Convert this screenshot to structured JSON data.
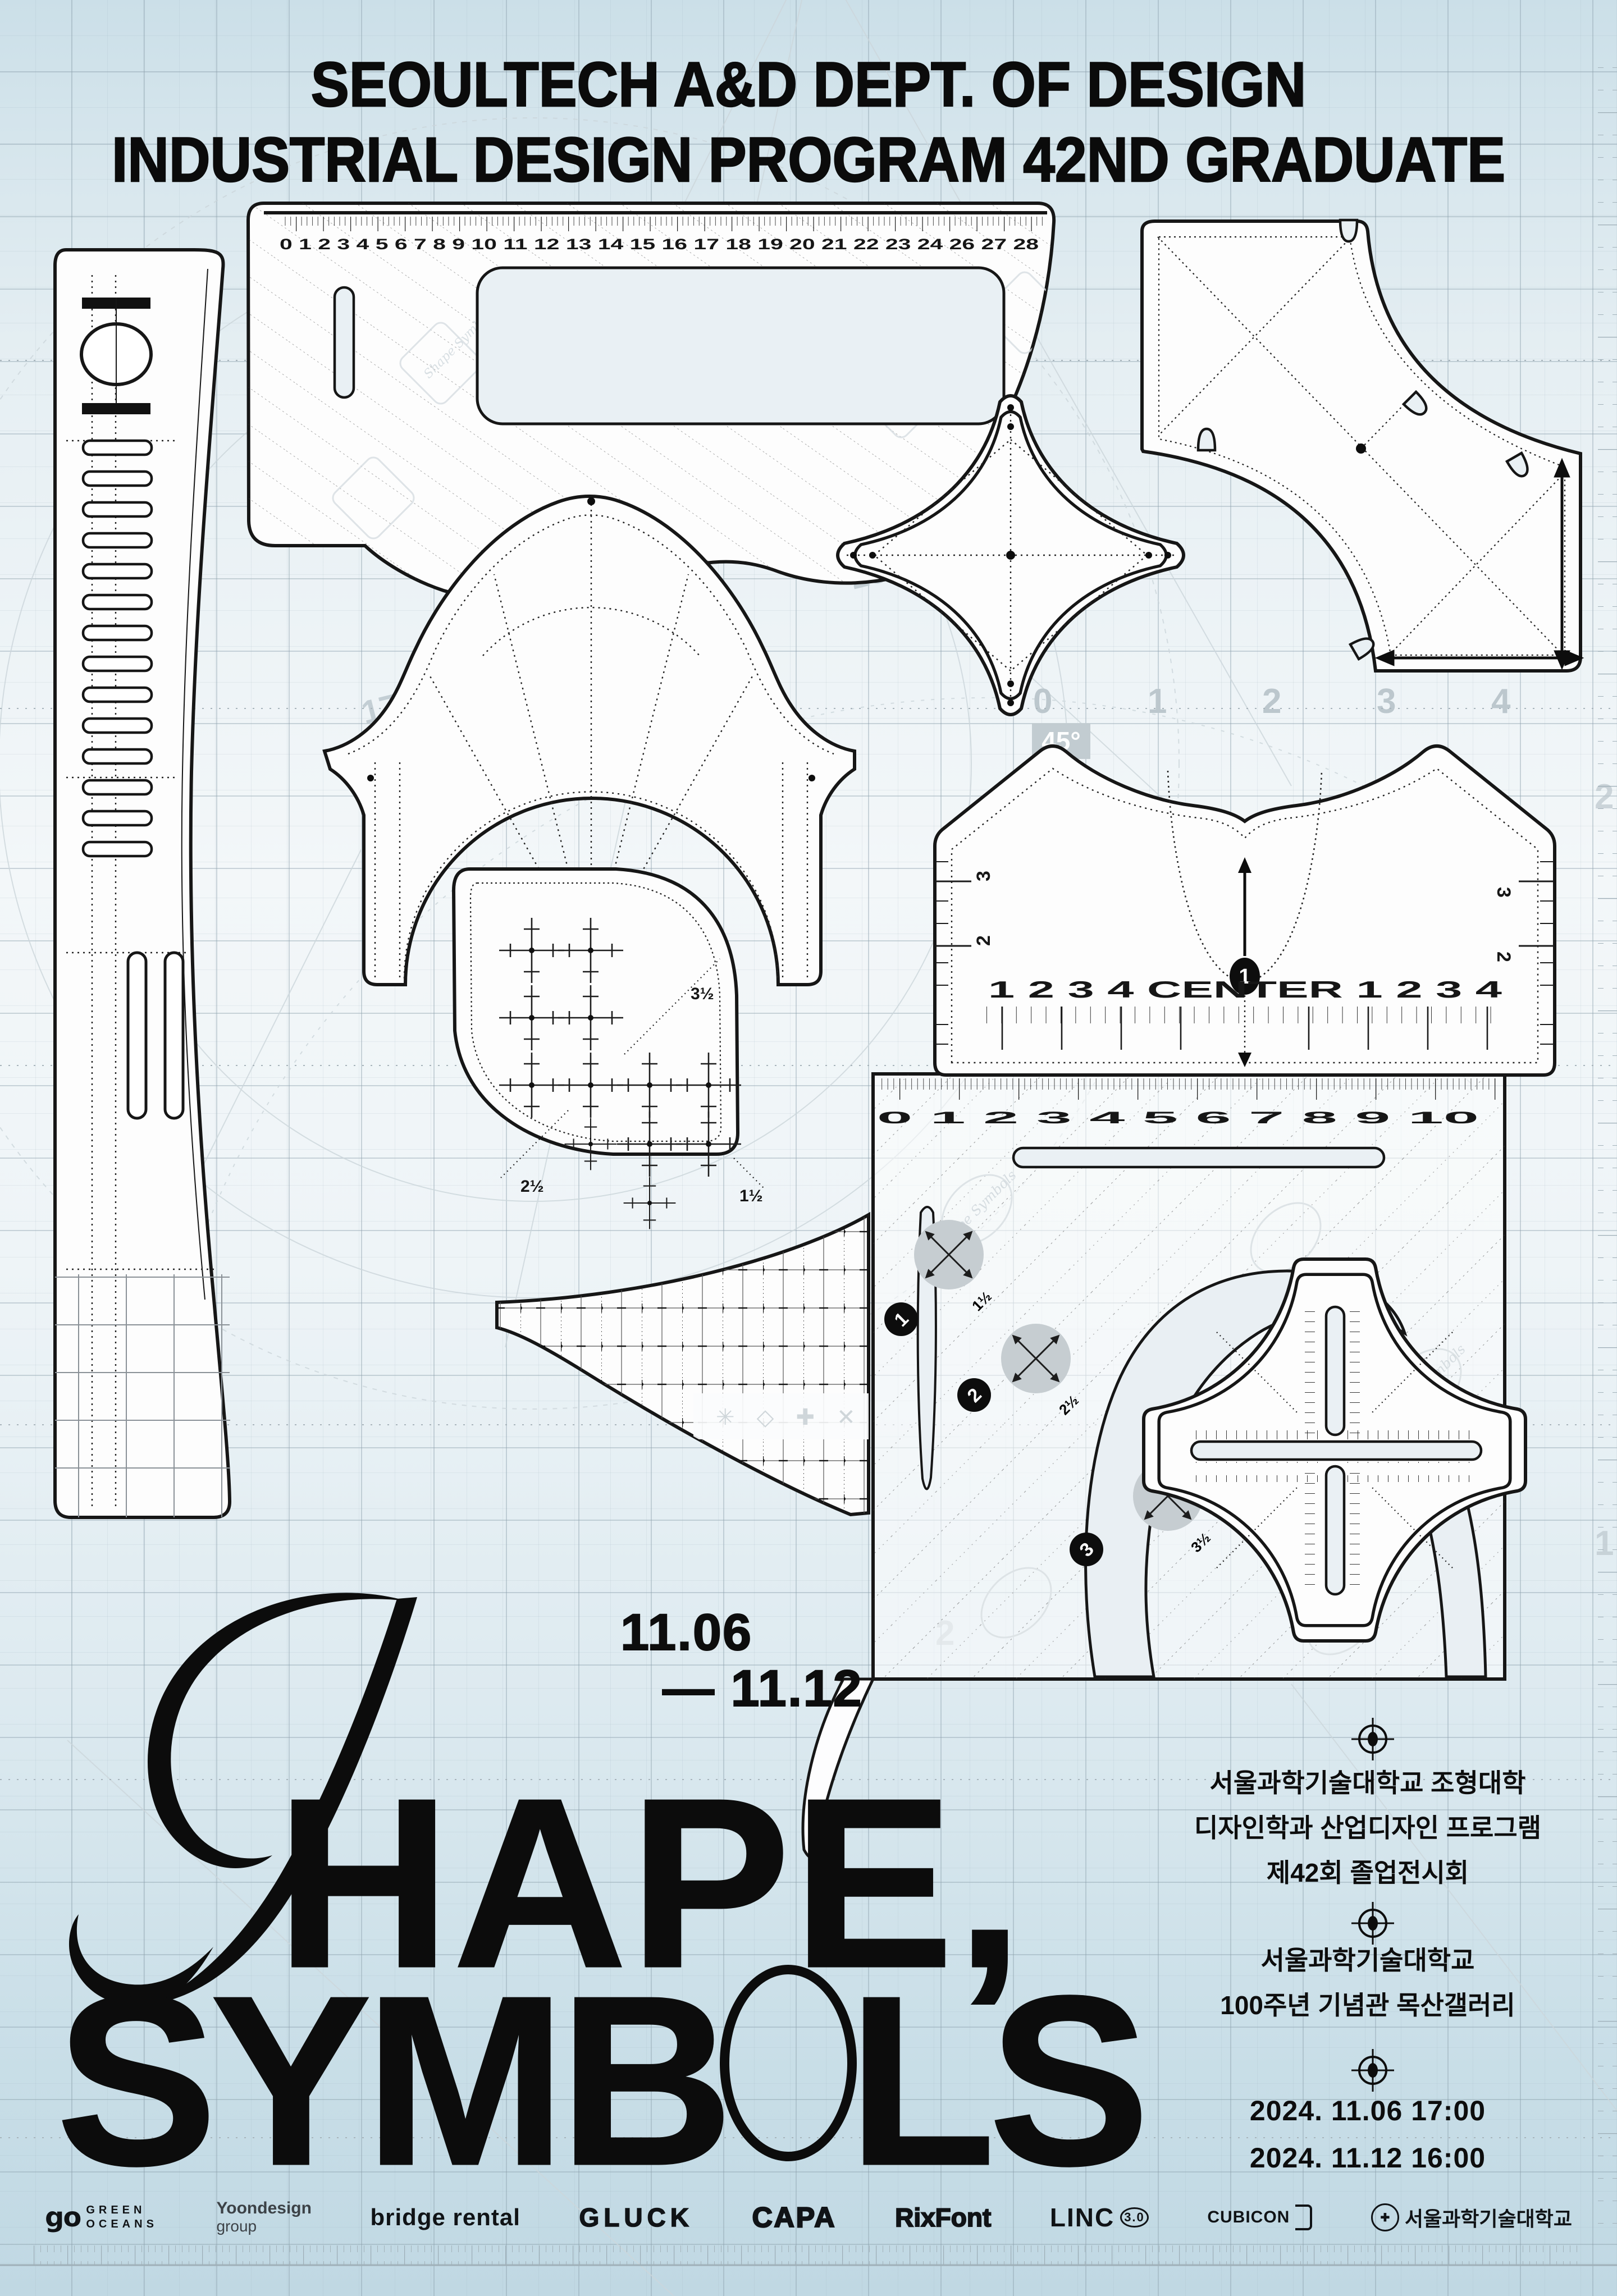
{
  "header": {
    "line1": "SEOULTECH A&D DEPT. OF DESIGN",
    "line2": "INDUSTRIAL DESIGN PROGRAM 42ND GRADUATE SHOW"
  },
  "dates_top": {
    "start": "11.06",
    "end": "— 11.12"
  },
  "title": {
    "script_letter": "S",
    "line1_rest": "HAPE,",
    "line2_pre": "SYMB",
    "line2_post": "LS"
  },
  "info": {
    "block1": [
      "서울과학기술대학교 조형대학",
      "디자인학과 산업디자인 프로그램",
      "제42회 졸업전시회"
    ],
    "block2": [
      "서울과학기술대학교",
      "100주년 기념관 목산갤러리"
    ],
    "block3": [
      "2024. 11.06  17:00",
      "2024. 11.12  16:00"
    ]
  },
  "rulers": {
    "triangle_scale": "0 1 2 3 4 5 6 7 8 9 10 11 12 13 14 15 16 17 18 19 20 21 22 23 24 26 27 28",
    "square_scale": "0 1 2 3 4 5 6 7 8 9 10",
    "square_circle_labels": [
      "1½",
      "2½",
      "3½"
    ],
    "square_point_numbers": [
      "1",
      "2",
      "3"
    ],
    "watermark": "Shape Symbols",
    "tshirt_bottom": "1 2 3 4 CENTER 1 2 3 4",
    "tshirt_marker": "1",
    "tshirt_side": [
      "3",
      "2"
    ],
    "grid_labels": [
      "3½",
      "2½",
      "1½"
    ],
    "mesh_ornaments": "✳ ◇ ✚ ✕ ✦"
  },
  "background": {
    "protractor": [
      "300",
      "280",
      "270",
      "250",
      "210",
      "200",
      "170",
      "150"
    ],
    "axis": [
      "0",
      "1",
      "2",
      "3",
      "4"
    ],
    "angle": "45°"
  },
  "sponsors": [
    {
      "mark": "go",
      "lines": [
        "GREEN",
        "OCEANS"
      ]
    },
    {
      "name": "Yoondesign",
      "sub": "group"
    },
    {
      "name": "bridge rental"
    },
    {
      "name": "GLUCK"
    },
    {
      "name": "CAPA"
    },
    {
      "name": "RixFont"
    },
    {
      "name": "LINC",
      "sub": "3.0"
    },
    {
      "name": "CUBICON"
    },
    {
      "name": "서울과학기술대학교",
      "seal": "✚"
    }
  ],
  "colors": {
    "ink": "#111111",
    "bg_top": "#cbdfe8",
    "bg_mid": "#f3f7f9",
    "bg_bottom": "#c0d8e3",
    "grid": "#9fb3bd"
  }
}
